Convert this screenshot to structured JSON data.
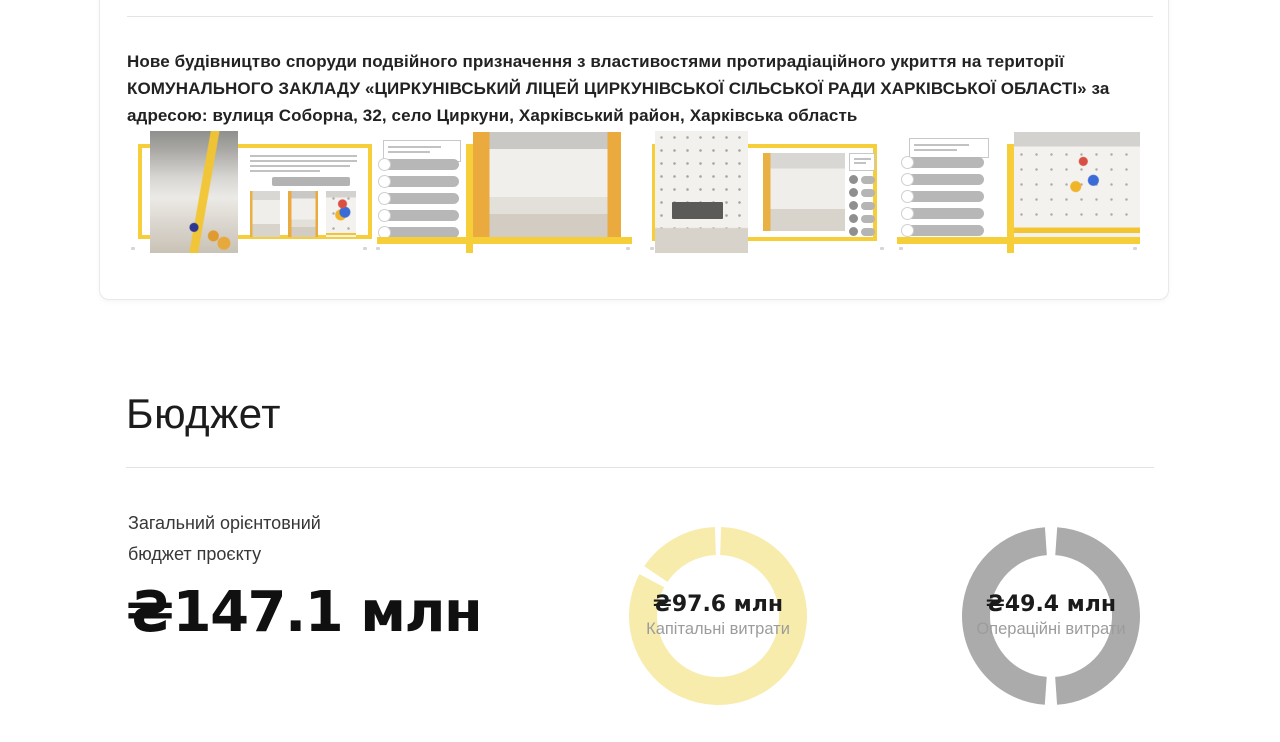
{
  "project_card": {
    "title": "Нове будівництво споруди подвійного призначення з властивостями протирадіаційного укриття на території КОМУНАЛЬНОГО ЗАКЛАДУ «ЦИРКУНІВСЬКИЙ ЛІЦЕЙ ЦИРКУНІВСЬКОЇ СІЛЬСЬКОЇ РАДИ ХАРКІВСЬКОЇ ОБЛАСТІ» за адресою: вулиця Соборна, 32, село Циркуни, Харківський район, Харківська область",
    "accent_color": "#F6CE3A",
    "thumbnails": [
      {
        "name": "slide-corridor",
        "description": "presentation slide preview — school corridor render in yellow frame with text and three small photos"
      },
      {
        "name": "slide-meeting-room",
        "description": "presentation slide preview — list of gray text blocks and meeting room render with yellow walls"
      },
      {
        "name": "slide-classroom",
        "description": "presentation slide preview — classroom render with dotted wall and icon list"
      },
      {
        "name": "slide-cafeteria",
        "description": "presentation slide preview — list of gray text blocks and cafeteria render"
      }
    ]
  },
  "budget_section": {
    "heading": "Бюджет",
    "label_lines": [
      "Загальний орієнтовний",
      "бюджет проєкту"
    ],
    "total_value": "₴147.1 млн"
  },
  "chart_data": [
    {
      "type": "donut",
      "title": "Капітальні витрати",
      "value": 97.6,
      "currency": "₴",
      "unit": "млн",
      "label": "₴97.6 млн",
      "sublabel": "Капітальні витрати",
      "ring_color": "#F8ECAC",
      "segments_deg": [
        [
          2,
          298
        ],
        [
          304,
          358
        ]
      ],
      "legend_position": "center"
    },
    {
      "type": "donut",
      "title": "Операційні витрати",
      "value": 49.4,
      "currency": "₴",
      "unit": "млн",
      "label": "₴49.4 млн",
      "sublabel": "Операційні витрати",
      "ring_color": "#ABABAB",
      "segments_deg": [
        [
          4,
          176
        ],
        [
          184,
          356
        ]
      ],
      "legend_position": "center"
    }
  ]
}
